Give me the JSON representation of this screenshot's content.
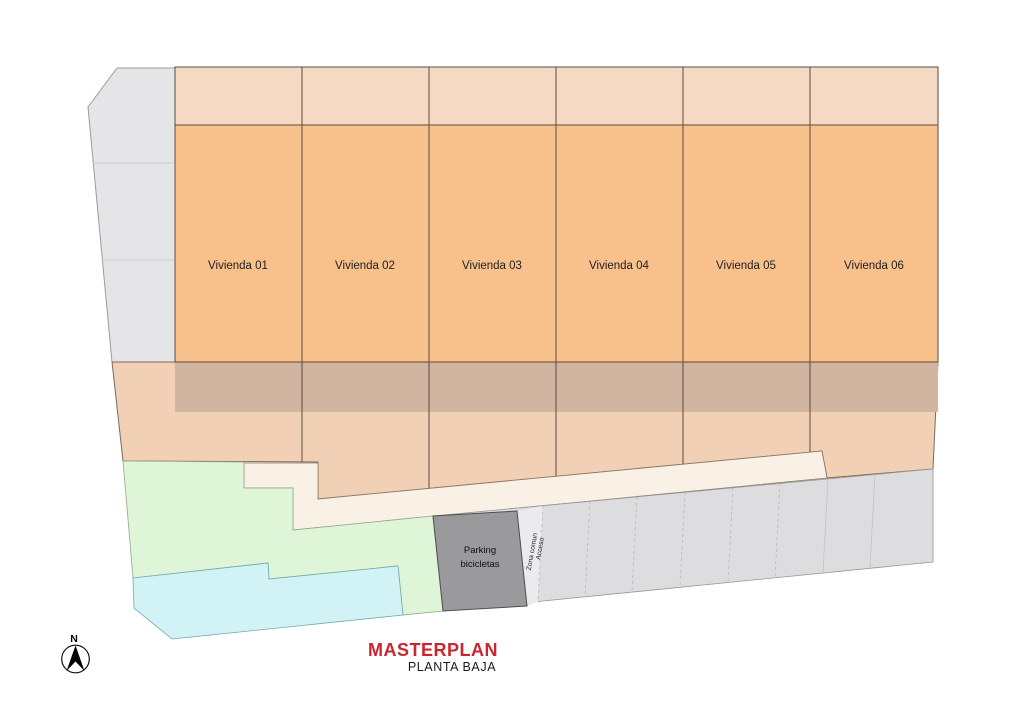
{
  "title": {
    "main": "MASTERPLAN",
    "sub": "PLANTA BAJA"
  },
  "compass": {
    "north_label": "N"
  },
  "viviendas": [
    {
      "label": "Vivienda 01"
    },
    {
      "label": "Vivienda 02"
    },
    {
      "label": "Vivienda 03"
    },
    {
      "label": "Vivienda 04"
    },
    {
      "label": "Vivienda 05"
    },
    {
      "label": "Vivienda 06"
    }
  ],
  "parking": {
    "line1": "Parking",
    "line2": "bicicletas"
  },
  "access": {
    "line1": "Acceso",
    "line2": "Zona comun"
  },
  "colors": {
    "plan_orange": "#F8C18C",
    "terrace_peach": "#F5D9C2",
    "rear_strip_tan": "#D2B5A1",
    "garden_peach": "#F2D0B5",
    "walkway_cream": "#FAF1E6",
    "green_area": "#DFF5D8",
    "pool_cyan": "#D2F3F6",
    "sidewalk_gray": "#E5E5E7",
    "parking_gray": "#DDDDDF",
    "access_lane_gray": "#EBEBED",
    "bike_box_gray": "#9A9A9C",
    "title_red": "#C9252C"
  }
}
